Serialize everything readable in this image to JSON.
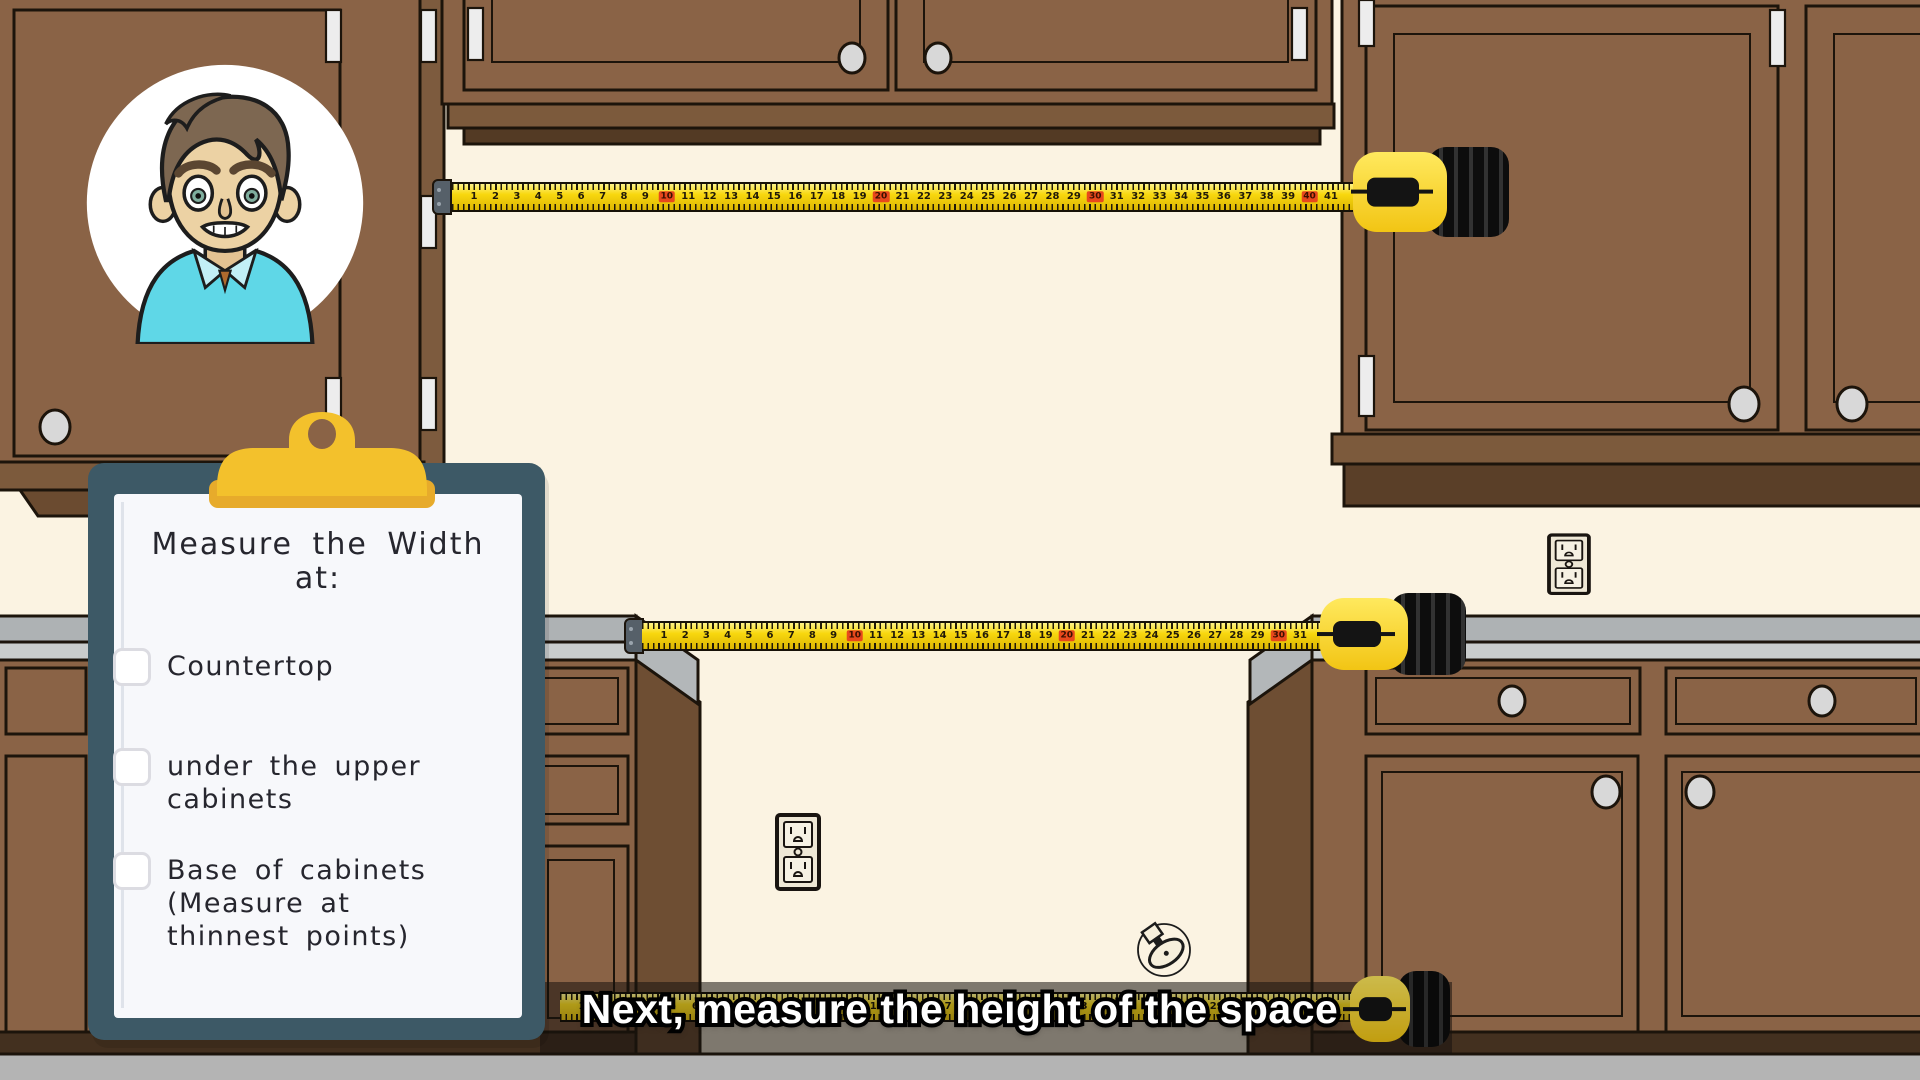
{
  "scene": "kitchen measuring tutorial frame",
  "clipboard": {
    "title": "Measure the Width",
    "subtitle": "at:",
    "items": [
      {
        "label": "Countertop",
        "checked": false
      },
      {
        "label": "under the upper cabinets",
        "checked": false
      },
      {
        "label": "Base of cabinets (Measure at thinnest points)",
        "checked": false
      }
    ]
  },
  "caption": {
    "text": "Next, measure the height of the space"
  },
  "tapes": {
    "highlight_every": 10,
    "top": {
      "first": 1,
      "last": 41
    },
    "middle": {
      "first": 1,
      "last": 31
    },
    "bottom": {
      "first": 1,
      "last": 34
    }
  },
  "icons": {
    "avatar": "presenter-avatar",
    "outlet": "duplex-outlet-icon",
    "valve": "gas-valve-icon",
    "tape_case": "tape-measure-case",
    "clip": "clipboard-clip",
    "checkbox": "checkbox"
  },
  "colors": {
    "wall": "#fbf3e2",
    "cabinet": "#8a6346",
    "cabinet_side": "#6e4e33",
    "trim": "#7c5a3c",
    "trim_dark": "#533a24",
    "counter_top": "#aeb2b4",
    "counter_front": "#c9cccc",
    "floor": "#b4b4b4",
    "tape_yellow": "#f8d70e",
    "tape_mark_red": "#e8481c",
    "board": "#3d5966",
    "clip_yellow": "#f3c12c",
    "paper": "#f7f8fb",
    "ink": "#26262e",
    "shirt": "#5fd7e7",
    "skin": "#ecd2a4",
    "hair": "#7d6751"
  }
}
